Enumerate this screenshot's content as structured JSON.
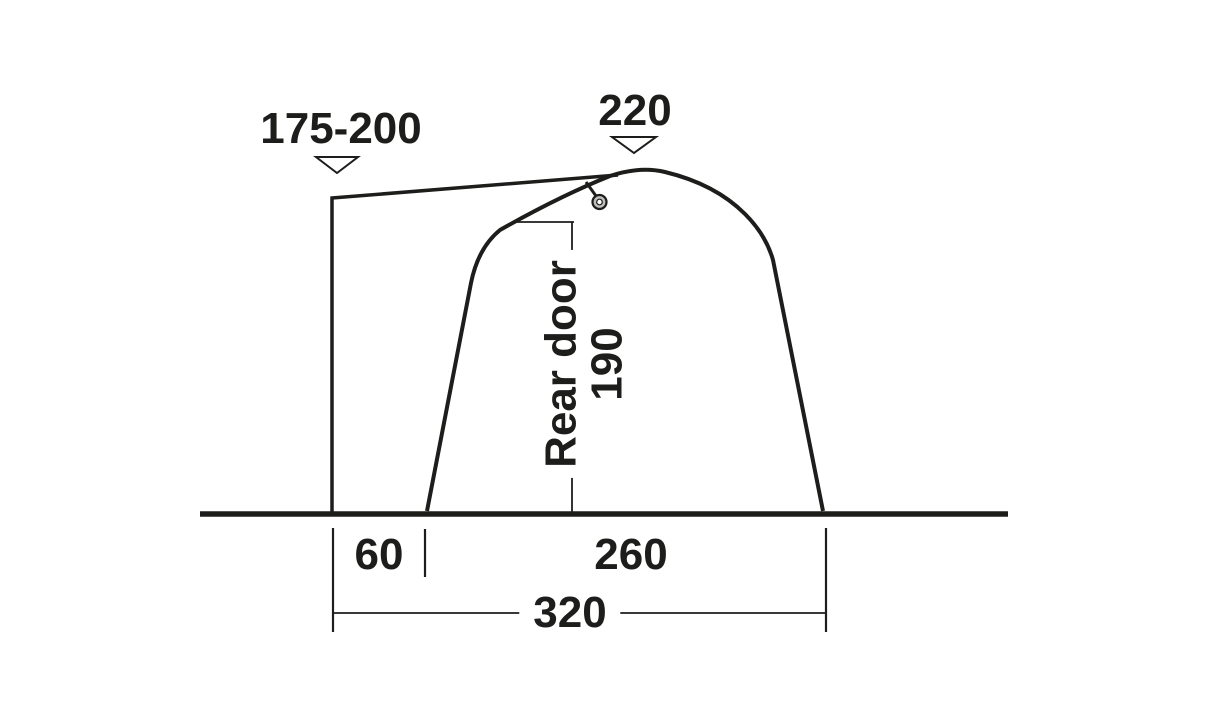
{
  "diagram": {
    "subject": "tent-side-profile-dimension-diagram",
    "labels": {
      "height_left": "175-200",
      "height_peak": "220",
      "rear_door_line1": "Rear door",
      "rear_door_line2": "190",
      "width_left": "60",
      "width_door": "260",
      "width_total": "320"
    },
    "dimensions": [
      {
        "value": "175-200",
        "kind": "height",
        "marker": "down-triangle",
        "refers_to": "left wall top"
      },
      {
        "value": "220",
        "kind": "height",
        "marker": "down-triangle",
        "refers_to": "peak"
      },
      {
        "value": "190",
        "kind": "height",
        "refers_to": "rear door"
      },
      {
        "value": "60",
        "kind": "width",
        "refers_to": "left section on ground"
      },
      {
        "value": "260",
        "kind": "width",
        "refers_to": "door section on ground"
      },
      {
        "value": "320",
        "kind": "width",
        "refers_to": "total on ground"
      }
    ],
    "icons": [
      "down-triangle-marker",
      "down-triangle-marker",
      "hook-ring-icon"
    ],
    "colors": {
      "line": "#1d1d1b",
      "text": "#1d1d1b",
      "background": "#ffffff",
      "ring_fill": "#bebebe"
    }
  }
}
